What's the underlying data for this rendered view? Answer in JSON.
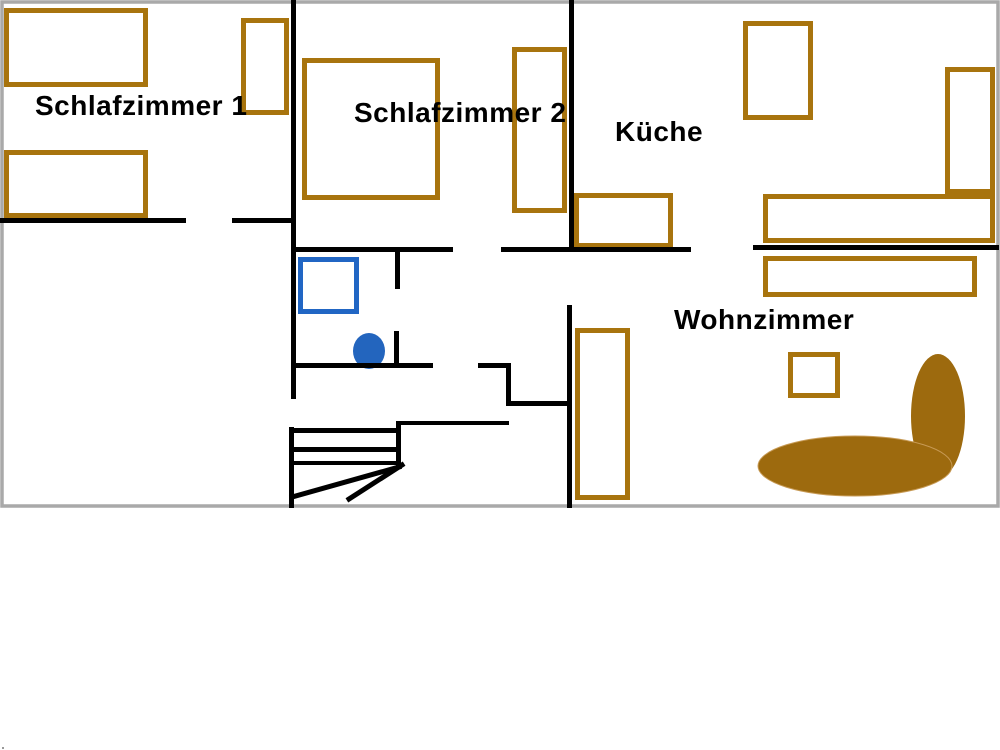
{
  "rooms": {
    "schlafzimmer1": {
      "label": "Schlafzimmer 1"
    },
    "schlafzimmer2": {
      "label": "Schlafzimmer 2"
    },
    "kueche": {
      "label": "Küche"
    },
    "wohnzimmer": {
      "label": "Wohnzimmer"
    }
  },
  "colors": {
    "wall": "#000000",
    "furniture_outline": "#a8740e",
    "sofa_fill": "#9d6a0e",
    "fixture_blue": "#2166c4",
    "fixture_fill": "#2365be",
    "border": "#a9a9a9",
    "label": "#000000",
    "background": "#ffffff"
  }
}
